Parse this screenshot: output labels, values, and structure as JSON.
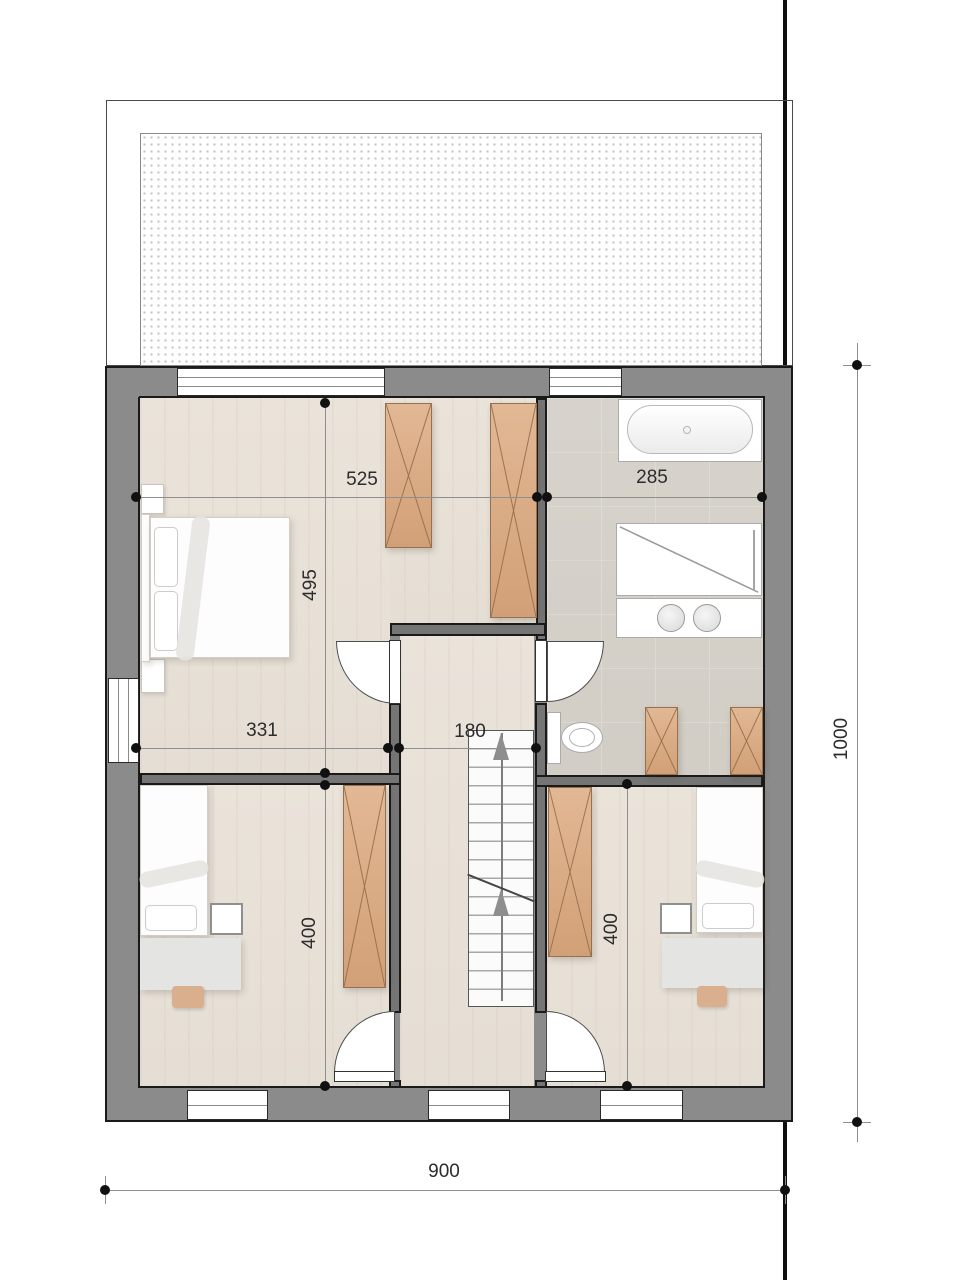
{
  "dimensions": {
    "master_width": "525",
    "bath_width": "285",
    "master_depth": "495",
    "room_left_width": "331",
    "stair_width": "180",
    "room_left_depth": "400",
    "room_right_depth": "400",
    "building_width": "900",
    "building_depth": "1000"
  },
  "colors": {
    "wall": "#8b8b8b",
    "wall-int": "#757575",
    "outline": "#1a1a1a",
    "floor-wood": "#e8e1d8",
    "floor-bath": "#d5d1ca",
    "wood-furn": "#dcae87",
    "dim": "#8e8e8e",
    "text": "#2c2c2c"
  }
}
